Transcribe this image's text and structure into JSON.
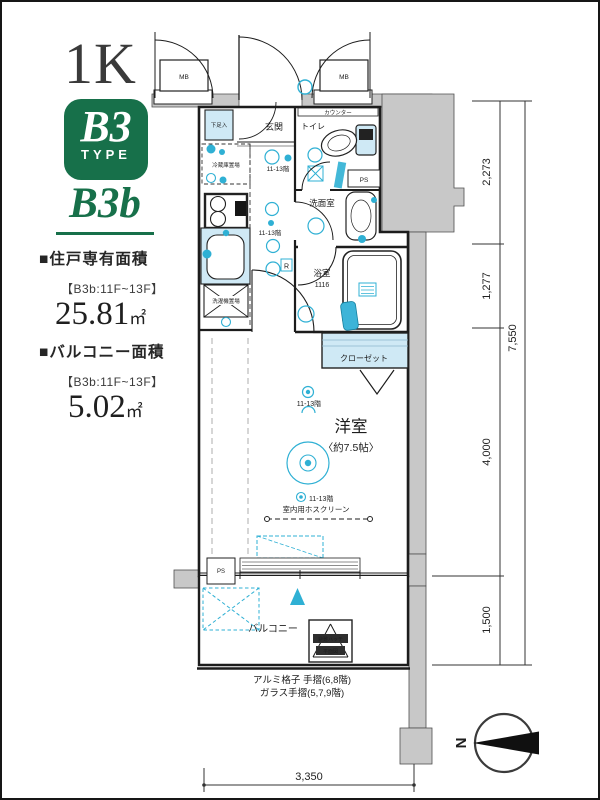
{
  "header": {
    "plan_type": "1K",
    "badge_code": "B3",
    "badge_label": "TYPE",
    "plan_variant": "B3b"
  },
  "areas": {
    "unit_heading": "■住戸専有面積",
    "unit_floor_range": "【B3b:11F~13F】",
    "unit_value": "25.81",
    "unit_unit": "㎡",
    "balcony_heading": "■バルコニー面積",
    "balcony_floor_range": "【B3b:11F~13F】",
    "balcony_value": "5.02",
    "balcony_unit": "㎡"
  },
  "plan": {
    "rooms": {
      "entrance": "玄関",
      "toilet": "トイレ",
      "washroom": "洗面室",
      "bathroom": "浴室",
      "bathroom_size": "1116",
      "closet": "クローゼット",
      "main_room": "洋室",
      "main_room_size": "〈約7.5帖〉",
      "balcony": "バルコニー"
    },
    "labels": {
      "shoe_cabinet": "下足入",
      "refrigerator": "冷蔵庫置場",
      "washer": "洗濯機置場",
      "counter": "カウンター",
      "meter_box": "MB",
      "pipe_space": "PS",
      "fridge_outlet": "R",
      "floors_note": "11-13階",
      "hoscreen": "室内用ホスクリーン",
      "hatch_line1": "避難ハッチ",
      "hatch_line2": "平面図"
    },
    "notes": {
      "handrail_line1": "アルミ格子 手摺(6,8階)",
      "handrail_line2": "ガラス手摺(5,7,9階)"
    }
  },
  "dimensions": {
    "upper": "2,273",
    "middle": "1,277",
    "total_right": "7,550",
    "room": "4,000",
    "balcony": "1,500",
    "bottom": "3,350"
  },
  "compass": {
    "north": "N"
  },
  "colors": {
    "green": "#17704a",
    "light_blue": "#cfe9f5",
    "cyan": "#2fb0d4",
    "gray": "#c8c8c8"
  }
}
